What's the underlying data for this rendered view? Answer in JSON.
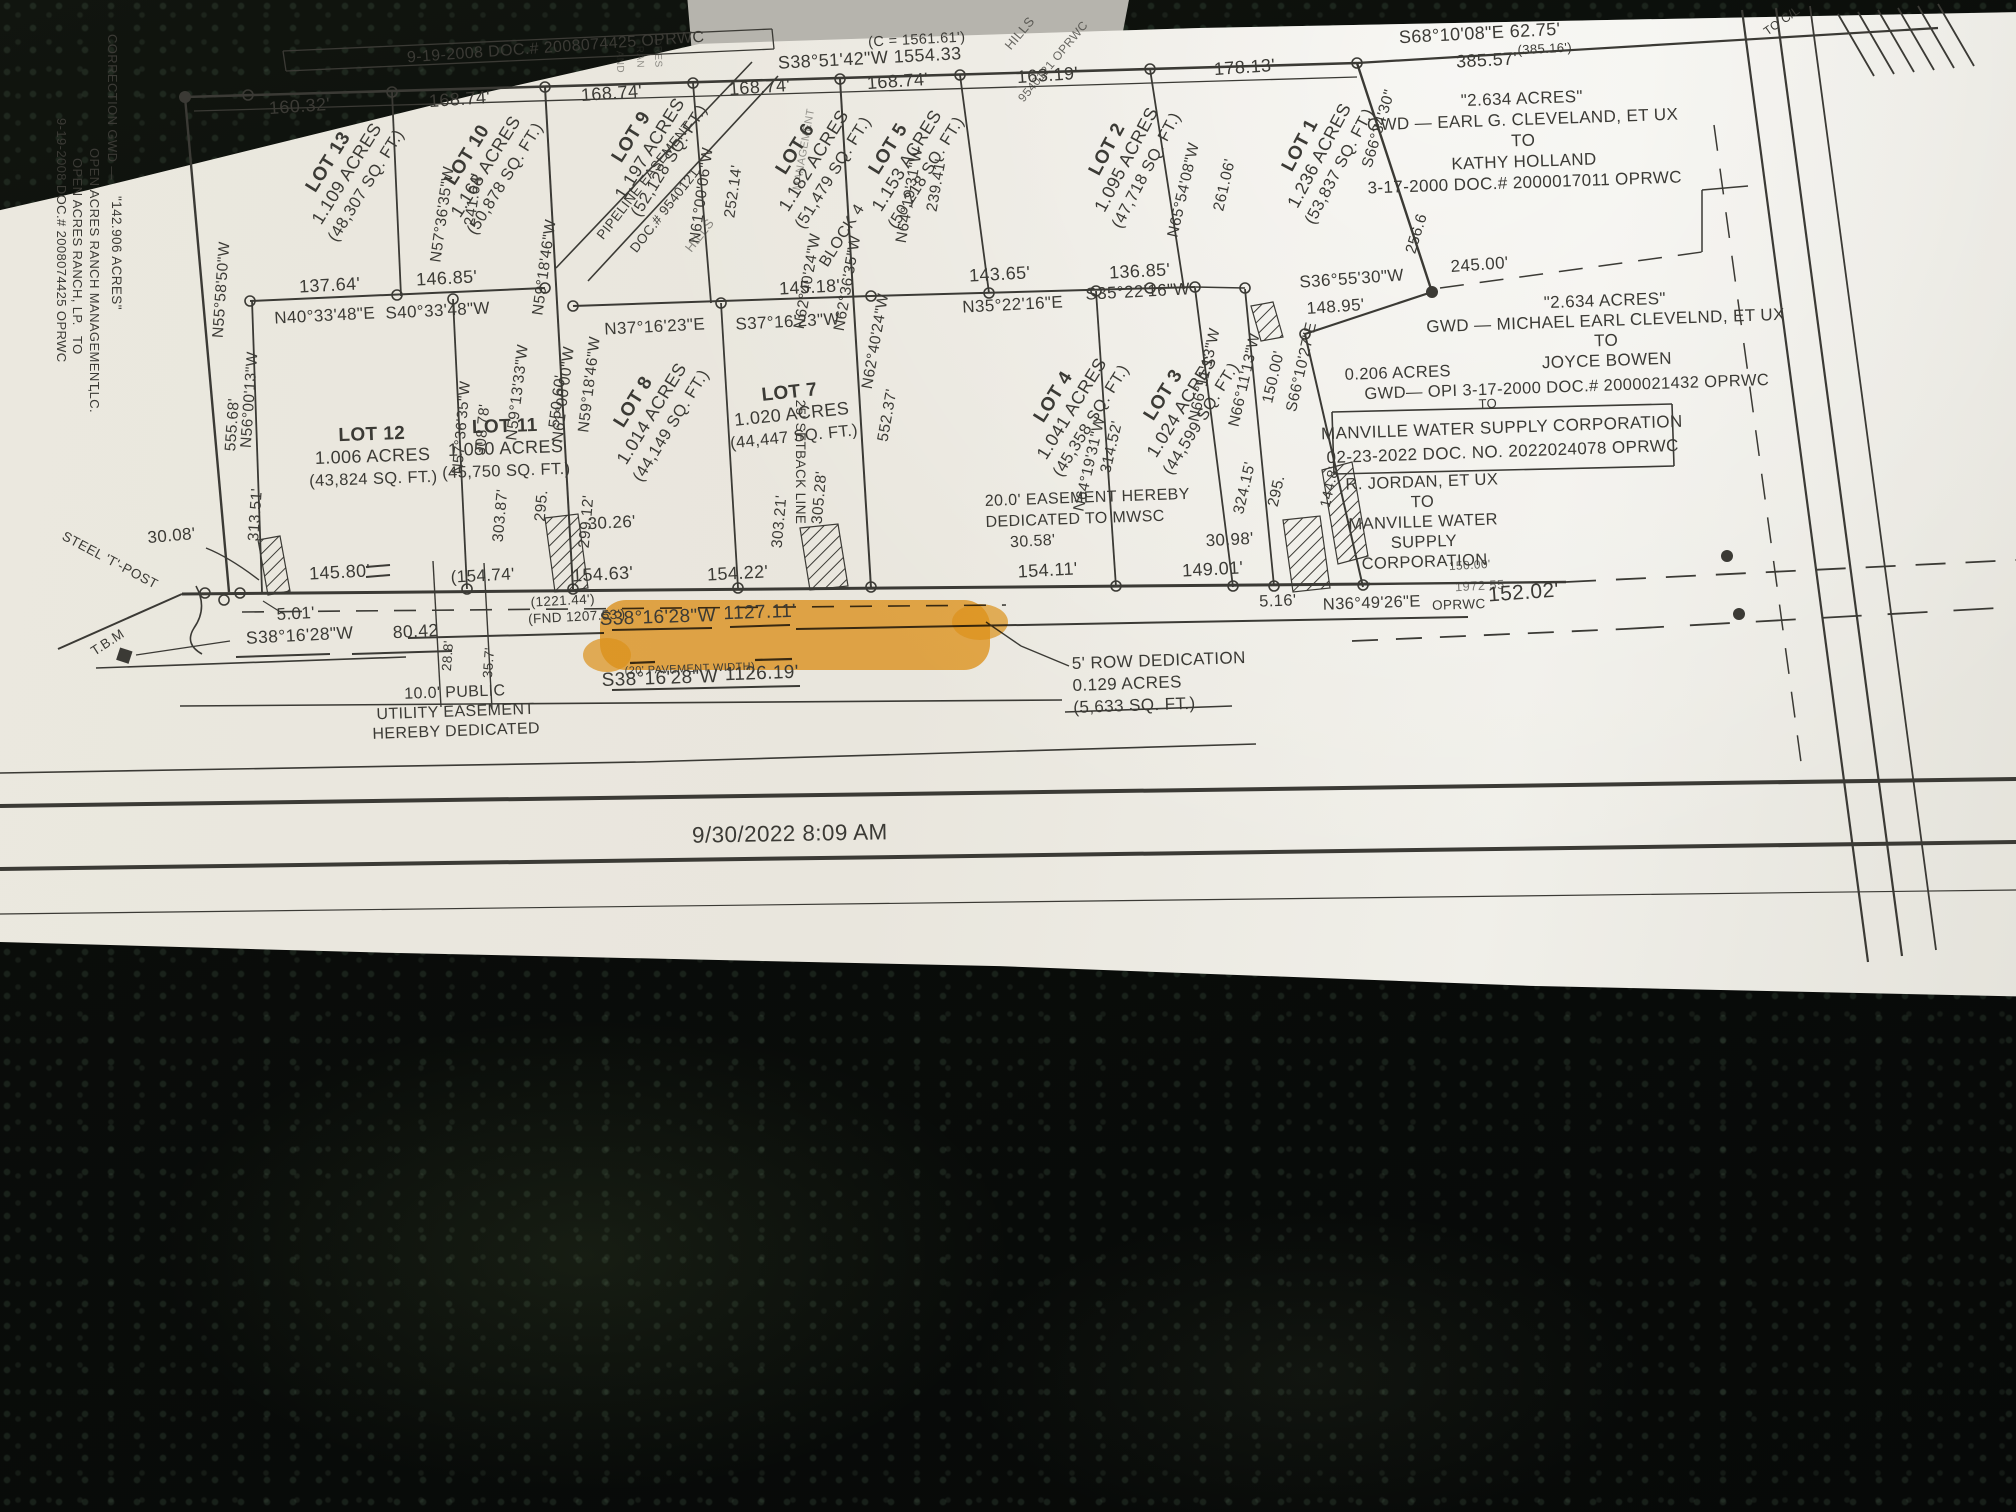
{
  "meta": {
    "ink": "#3b3a35",
    "faint_ink": "#6f6e67",
    "highlight_color": "#f09f1e",
    "paper_color": "#e9e6dd",
    "background_color": "#0a0d0a",
    "date_stamp": "9/30/2022 8:09 AM",
    "highlight_text": "WCR NO. 468"
  },
  "lots": [
    {
      "lot": "LOT 13",
      "acres": "1.109 ACRES",
      "sqft": "(48,307 SQ. FT.)",
      "x": 333,
      "y": 165,
      "r": -58
    },
    {
      "lot": "LOT 10",
      "acres": "1.168 ACRES",
      "sqft": "(50,878 SQ. FT.)",
      "x": 472,
      "y": 158,
      "r": -58
    },
    {
      "lot": "LOT 9",
      "acres": "1.197 ACRES",
      "sqft": "(52,128 SQ. FT.)",
      "x": 636,
      "y": 140,
      "r": -58
    },
    {
      "lot": "LOT 6",
      "acres": "1.182 ACRES",
      "sqft": "(51,479 SQ. FT.)",
      "x": 800,
      "y": 152,
      "r": -58
    },
    {
      "lot": "LOT 5",
      "acres": "1.153 ACRES",
      "sqft": "(50,218 SQ. FT.)",
      "x": 893,
      "y": 152,
      "r": -58
    },
    {
      "lot": "LOT 2",
      "acres": "1.095 ACRES",
      "sqft": "(47,718 SQ. FT.)",
      "x": 1112,
      "y": 152,
      "r": -62
    },
    {
      "lot": "LOT 1",
      "acres": "1.236 ACRES",
      "sqft": "(53,837 SQ. FT.)",
      "x": 1305,
      "y": 148,
      "r": -62
    },
    {
      "lot": "LOT 12",
      "acres": "1.006 ACRES",
      "sqft": "(43,824 SQ. FT.)",
      "x": 372,
      "y": 440,
      "r": -2
    },
    {
      "lot": "LOT 11",
      "acres": "1.050 ACRES",
      "sqft": "(45,750 SQ. FT.)",
      "x": 505,
      "y": 432,
      "r": -2
    },
    {
      "lot": "LOT 8",
      "acres": "1.014 ACRES",
      "sqft": "(44,149 SQ. FT.)",
      "x": 638,
      "y": 405,
      "r": -58
    },
    {
      "lot": "LOT 7",
      "acres": "1.020 ACRES",
      "sqft": "(44,447 SQ. FT.)",
      "x": 790,
      "y": 398,
      "r": -6
    },
    {
      "lot": "LOT 4",
      "acres": "1.041 ACRES",
      "sqft": "(45,358 SQ. FT.)",
      "x": 1058,
      "y": 400,
      "r": -58
    },
    {
      "lot": "LOT 3",
      "acres": "1.024 ACRES",
      "sqft": "(44,599 SQ. FT.)",
      "x": 1168,
      "y": 398,
      "r": -58
    }
  ],
  "labels": [
    {
      "t": "9-19-2008 DOC.# 2008074425 OPRWC",
      "x": 556,
      "y": 52,
      "r": -4,
      "s": 16
    },
    {
      "t": "(C = 1561.61')",
      "x": 917,
      "y": 44,
      "r": -3,
      "s": 14.5
    },
    {
      "t": "S38°51'42\"W  1554.33",
      "x": 870,
      "y": 64,
      "r": -3,
      "s": 18
    },
    {
      "t": "160.32'",
      "x": 300,
      "y": 112,
      "r": -4,
      "s": 18
    },
    {
      "t": "168.74'",
      "x": 460,
      "y": 105,
      "r": -4,
      "s": 18
    },
    {
      "t": "168.74'",
      "x": 612,
      "y": 99,
      "r": -4,
      "s": 18
    },
    {
      "t": "168.74'",
      "x": 760,
      "y": 93,
      "r": -4,
      "s": 18
    },
    {
      "t": "168.74'",
      "x": 898,
      "y": 87,
      "r": -4,
      "s": 18
    },
    {
      "t": "163.19'",
      "x": 1048,
      "y": 81,
      "r": -4,
      "s": 18
    },
    {
      "t": "178.13'",
      "x": 1245,
      "y": 73,
      "r": -4,
      "s": 18
    },
    {
      "t": "S68°10'08\"E   62.75'",
      "x": 1480,
      "y": 39,
      "r": -3,
      "s": 18
    },
    {
      "t": "385.57'",
      "x": 1487,
      "y": 66,
      "r": -3,
      "s": 18
    },
    {
      "t": "(385.16')",
      "x": 1545,
      "y": 53,
      "r": -3,
      "s": 13
    },
    {
      "t": "TO C/L",
      "x": 1784,
      "y": 24,
      "r": -35,
      "s": 12
    },
    {
      "t": "S66°34'30\"",
      "x": 1383,
      "y": 130,
      "r": -73,
      "s": 15.5
    },
    {
      "t": "256.6",
      "x": 1421,
      "y": 235,
      "r": -73,
      "s": 15.5
    },
    {
      "t": "245.00'",
      "x": 1480,
      "y": 270,
      "r": -4,
      "s": 17
    },
    {
      "t": "S36°55'30\"W",
      "x": 1352,
      "y": 284,
      "r": -4,
      "s": 17
    },
    {
      "t": "148.95'",
      "x": 1336,
      "y": 312,
      "r": -4,
      "s": 17
    },
    {
      "t": "137.64'",
      "x": 330,
      "y": 291,
      "r": -3,
      "s": 18
    },
    {
      "t": "146.85'",
      "x": 447,
      "y": 284,
      "r": -3,
      "s": 18
    },
    {
      "t": "145.18'",
      "x": 810,
      "y": 293,
      "r": -3,
      "s": 18
    },
    {
      "t": "143.65'",
      "x": 1000,
      "y": 280,
      "r": -3,
      "s": 18
    },
    {
      "t": "136.85'",
      "x": 1140,
      "y": 277,
      "r": -3,
      "s": 18
    },
    {
      "t": "N40°33'48\"E",
      "x": 325,
      "y": 321,
      "r": -3,
      "s": 17
    },
    {
      "t": "S40°33'48\"W",
      "x": 438,
      "y": 316,
      "r": -3,
      "s": 17
    },
    {
      "t": "N37°16'23\"E",
      "x": 655,
      "y": 332,
      "r": -3,
      "s": 17
    },
    {
      "t": "S37°16'23\"W",
      "x": 788,
      "y": 327,
      "r": -3,
      "s": 17
    },
    {
      "t": "N35°22'16\"E",
      "x": 1013,
      "y": 310,
      "r": -3,
      "s": 17
    },
    {
      "t": "S35°22'16\"W",
      "x": 1138,
      "y": 297,
      "r": -3,
      "s": 17
    },
    {
      "t": "N55°58'50\"W",
      "x": 226,
      "y": 290,
      "r": -86,
      "s": 15.5
    },
    {
      "t": "555.68'",
      "x": 237,
      "y": 425,
      "r": -86,
      "s": 15.5
    },
    {
      "t": "N56°00'13\"W",
      "x": 254,
      "y": 400,
      "r": -86,
      "s": 15.5
    },
    {
      "t": "313.51'",
      "x": 260,
      "y": 515,
      "r": -86,
      "s": 15.5
    },
    {
      "t": "N57°36'35\"W",
      "x": 447,
      "y": 215,
      "r": -82,
      "s": 15.5
    },
    {
      "t": "241.64'",
      "x": 478,
      "y": 200,
      "r": -82,
      "s": 15.5
    },
    {
      "t": "N59°18'46\"W",
      "x": 549,
      "y": 268,
      "r": -82,
      "s": 15.5
    },
    {
      "t": "550.60'",
      "x": 562,
      "y": 402,
      "r": -83,
      "s": 15.5
    },
    {
      "t": "N59°13'33\"W",
      "x": 522,
      "y": 393,
      "r": -83,
      "s": 15.5
    },
    {
      "t": "N59°18'46\"W",
      "x": 594,
      "y": 385,
      "r": -83,
      "s": 15.5
    },
    {
      "t": "303.87'",
      "x": 505,
      "y": 516,
      "r": -85,
      "s": 15.5
    },
    {
      "t": "295.",
      "x": 546,
      "y": 506,
      "r": -85,
      "s": 15.5
    },
    {
      "t": "N57°36'35\"W",
      "x": 466,
      "y": 428,
      "r": -85,
      "s": 15
    },
    {
      "t": "308.78'",
      "x": 487,
      "y": 430,
      "r": -85,
      "s": 15
    },
    {
      "t": "N61°00'00\"W",
      "x": 568,
      "y": 395,
      "r": -83,
      "s": 15.5
    },
    {
      "t": "299.12'",
      "x": 591,
      "y": 522,
      "r": -85,
      "s": 15.5
    },
    {
      "t": "N61°00'06\"W",
      "x": 706,
      "y": 196,
      "r": -82,
      "s": 15.5
    },
    {
      "t": "252.14'",
      "x": 738,
      "y": 192,
      "r": -82,
      "s": 15.5
    },
    {
      "t": "N62°40'24\"W",
      "x": 812,
      "y": 282,
      "r": -80,
      "s": 15.5
    },
    {
      "t": "N62°36'35\"W",
      "x": 852,
      "y": 284,
      "r": -80,
      "s": 15.5
    },
    {
      "t": "N62°40'24\"W",
      "x": 880,
      "y": 342,
      "r": -80,
      "s": 15.5
    },
    {
      "t": "552.37'",
      "x": 892,
      "y": 416,
      "r": -80,
      "s": 15.5
    },
    {
      "t": "303.21'",
      "x": 784,
      "y": 522,
      "r": -85,
      "s": 15.5
    },
    {
      "t": "305.28'",
      "x": 824,
      "y": 498,
      "r": -85,
      "s": 15.5
    },
    {
      "t": "N64°19'31\"W",
      "x": 914,
      "y": 196,
      "r": -80,
      "s": 15.5
    },
    {
      "t": "239.41'",
      "x": 941,
      "y": 186,
      "r": -80,
      "s": 15.5
    },
    {
      "t": "N64°19'31\"W",
      "x": 1094,
      "y": 465,
      "r": -77,
      "s": 15.5
    },
    {
      "t": "314.52'",
      "x": 1116,
      "y": 448,
      "r": -77,
      "s": 15.5
    },
    {
      "t": "N65°54'08\"W",
      "x": 1188,
      "y": 191,
      "r": -77,
      "s": 15.5
    },
    {
      "t": "261.06'",
      "x": 1229,
      "y": 186,
      "r": -77,
      "s": 15.5
    },
    {
      "t": "N66°11'13\"W",
      "x": 1209,
      "y": 376,
      "r": -77,
      "s": 15.5
    },
    {
      "t": "324.15'",
      "x": 1249,
      "y": 489,
      "r": -77,
      "s": 15.5
    },
    {
      "t": "N66°11'13\"W",
      "x": 1249,
      "y": 381,
      "r": -77,
      "s": 15.5
    },
    {
      "t": "295.",
      "x": 1281,
      "y": 492,
      "r": -77,
      "s": 15.5
    },
    {
      "t": "S66°10'27\"E",
      "x": 1306,
      "y": 368,
      "r": -77,
      "s": 15.5
    },
    {
      "t": "150.00'",
      "x": 1278,
      "y": 378,
      "r": -77,
      "s": 15.5
    },
    {
      "t": "144.8'",
      "x": 1334,
      "y": 488,
      "r": -77,
      "s": 14.5
    },
    {
      "t": "25' SETBACK LINE",
      "x": 796,
      "y": 462,
      "r": 90,
      "s": 13.5
    },
    {
      "t": "BLOCK 4",
      "x": 846,
      "y": 238,
      "r": -58,
      "s": 16
    },
    {
      "t": "30.08'",
      "x": 172,
      "y": 541,
      "r": -5,
      "s": 17
    },
    {
      "t": "145.80'",
      "x": 340,
      "y": 578,
      "r": -3,
      "s": 18
    },
    {
      "t": "(154.74'",
      "x": 483,
      "y": 581,
      "r": -3,
      "s": 17
    },
    {
      "t": "154.63'",
      "x": 603,
      "y": 580,
      "r": -3,
      "s": 18
    },
    {
      "t": "154.22'",
      "x": 738,
      "y": 579,
      "r": -3,
      "s": 18
    },
    {
      "t": "154.11'",
      "x": 1048,
      "y": 576,
      "r": -3,
      "s": 18
    },
    {
      "t": "149.01'",
      "x": 1213,
      "y": 575,
      "r": -3,
      "s": 18
    },
    {
      "t": "30.26'",
      "x": 612,
      "y": 528,
      "r": -3,
      "s": 17
    },
    {
      "t": "30.58'",
      "x": 1033,
      "y": 546,
      "r": -3,
      "s": 16
    },
    {
      "t": "30.98'",
      "x": 1230,
      "y": 545,
      "r": -3,
      "s": 17
    },
    {
      "t": "5.01'",
      "x": 296,
      "y": 619,
      "r": -3,
      "s": 17
    },
    {
      "t": "S38°16'28\"W",
      "x": 300,
      "y": 641,
      "r": -3,
      "s": 17.5
    },
    {
      "t": "80.42",
      "x": 416,
      "y": 637,
      "r": -3,
      "s": 17.5
    },
    {
      "t": "T.B.M",
      "x": 110,
      "y": 646,
      "r": -33,
      "s": 13.5
    },
    {
      "t": "STEEL 'T'-POST",
      "x": 108,
      "y": 564,
      "r": 28,
      "s": 13.5
    },
    {
      "t": "28.8'",
      "x": 452,
      "y": 656,
      "r": -86,
      "s": 13.5
    },
    {
      "t": "35.7'",
      "x": 493,
      "y": 663,
      "r": -86,
      "s": 13.5
    },
    {
      "t": "(1221.44')",
      "x": 563,
      "y": 605,
      "r": -3,
      "s": 13.5
    },
    {
      "t": "(FND 1207.53')",
      "x": 577,
      "y": 621,
      "r": -3,
      "s": 13.5
    },
    {
      "t": "S38°16'28\"W",
      "x": 658,
      "y": 623,
      "r": -2,
      "s": 19
    },
    {
      "t": "1127.11'",
      "x": 760,
      "y": 618,
      "r": -2,
      "s": 19
    },
    {
      "t": "(20' PAVEMENT WIDTH)",
      "x": 690,
      "y": 672,
      "r": -2,
      "s": 11
    },
    {
      "t": "S38°16'28\"W",
      "x": 660,
      "y": 684,
      "r": -2,
      "s": 19
    },
    {
      "t": "1126.19'",
      "x": 762,
      "y": 679,
      "r": -2,
      "s": 19
    },
    {
      "t": "5.16'",
      "x": 1278,
      "y": 606,
      "r": -2,
      "s": 16.5
    },
    {
      "t": "N36°49'26\"E",
      "x": 1372,
      "y": 608,
      "r": -2,
      "s": 16.5
    },
    {
      "t": "OPRWC",
      "x": 1459,
      "y": 609,
      "r": -2,
      "s": 13.5
    },
    {
      "t": "1972 55",
      "x": 1480,
      "y": 590,
      "r": -3,
      "s": 13,
      "o": 0.65
    },
    {
      "t": "150.00'",
      "x": 1470,
      "y": 569,
      "r": -3,
      "s": 12,
      "o": 0.8
    },
    {
      "t": "152.02'",
      "x": 1524,
      "y": 599,
      "r": -4,
      "s": 21
    },
    {
      "t": "0.206 ACRES",
      "x": 1398,
      "y": 378,
      "r": -2,
      "s": 16.5
    },
    {
      "t": "TO",
      "x": 1488,
      "y": 408,
      "r": -2,
      "s": 13
    },
    {
      "t": "GWD— OPI 3-17-2000 DOC.# 2000021432 OPRWC",
      "x": 1567,
      "y": 392,
      "r": -2,
      "s": 16.5
    },
    {
      "t": "PIPELINE EASEMENT",
      "x": 648,
      "y": 183,
      "r": -52,
      "s": 13.5
    },
    {
      "t": "DOC.# 9540121",
      "x": 668,
      "y": 213,
      "r": -52,
      "s": 13.5
    },
    {
      "t": "HILLS",
      "x": 703,
      "y": 238,
      "r": -52,
      "s": 13,
      "o": 0.55
    },
    {
      "t": "HILLS",
      "x": 1023,
      "y": 36,
      "r": -50,
      "s": 13,
      "o": 0.75
    },
    {
      "t": "9540121 OPRWC",
      "x": 1056,
      "y": 64,
      "r": -50,
      "s": 12,
      "o": 0.75
    },
    {
      "t": "AND",
      "x": 617,
      "y": 62,
      "r": 88,
      "s": 10,
      "o": 0.55
    },
    {
      "t": "RAN",
      "x": 637,
      "y": 57,
      "r": 88,
      "s": 10,
      "o": 0.5
    },
    {
      "t": "DRES",
      "x": 655,
      "y": 53,
      "r": 88,
      "s": 10,
      "o": 0.55
    },
    {
      "t": "MANAGEMENT",
      "x": 807,
      "y": 150,
      "r": -80,
      "s": 11,
      "o": 0.5
    }
  ],
  "deeds": [
    {
      "lines": [
        "\"2.634 ACRES\"",
        "GWD — EARL G. CLEVELAND, ET UX",
        "TO",
        "KATHY HOLLAND",
        "3-17-2000 DOC.# 2000017011 OPRWC"
      ],
      "x": 1522,
      "y": 104,
      "lh": 21,
      "s": 17
    },
    {
      "lines": [
        "\"2.634 ACRES\"",
        "GWD — MICHAEL EARL CLEVELND, ET UX",
        "TO",
        "JOYCE BOWEN"
      ],
      "x": 1605,
      "y": 306,
      "lh": 20,
      "s": 17
    },
    {
      "lines": [
        "MANVILLE WATER SUPPLY CORPORATION",
        "02-23-2022 DOC. NO. 2022024078 OPRWC"
      ],
      "x": 1502,
      "y": 433,
      "lh": 24,
      "s": 17
    },
    {
      "lines": [
        "R. JORDAN, ET UX",
        "TO",
        "MANVILLE WATER",
        "SUPPLY",
        "CORPORATION"
      ],
      "x": 1422,
      "y": 487,
      "lh": 20,
      "s": 16.5
    }
  ],
  "notes": [
    {
      "lines": [
        "20.0' EASEMENT HEREBY",
        "DEDICATED TO MWSC"
      ],
      "x": 985,
      "y": 506,
      "lh": 21,
      "s": 16,
      "a": "start"
    },
    {
      "lines": [
        "5' ROW DEDICATION",
        "0.129 ACRES",
        "(5,633 SQ. FT.)"
      ],
      "x": 1072,
      "y": 669,
      "lh": 22,
      "s": 17,
      "a": "start"
    },
    {
      "lines": [
        "10.0' PUBLIC",
        "UTILITY EASEMENT",
        "HEREBY DEDICATED"
      ],
      "x": 455,
      "y": 697,
      "lh": 19.5,
      "s": 16,
      "a": "middle"
    }
  ],
  "margin_notes": [
    {
      "t": "9-19-2008 DOC.# 2008074425 OPRWC",
      "x": 57,
      "y": 118,
      "s": 13
    },
    {
      "t": "OPEN ACRES RANCH, LP.",
      "x": 73,
      "y": 158,
      "s": 13
    },
    {
      "t": "TO",
      "x": 73,
      "y": 336,
      "s": 13
    },
    {
      "t": "OPEN ACRES RANCH MANAGEMENT,",
      "x": 90,
      "y": 148,
      "s": 13
    },
    {
      "t": "LLC.",
      "x": 90,
      "y": 384,
      "s": 13
    },
    {
      "t": "CORRECTION GWD —",
      "x": 108,
      "y": 34,
      "s": 13
    },
    {
      "t": "\"142.906 ACRES\"",
      "x": 112,
      "y": 196,
      "s": 13.5
    }
  ]
}
